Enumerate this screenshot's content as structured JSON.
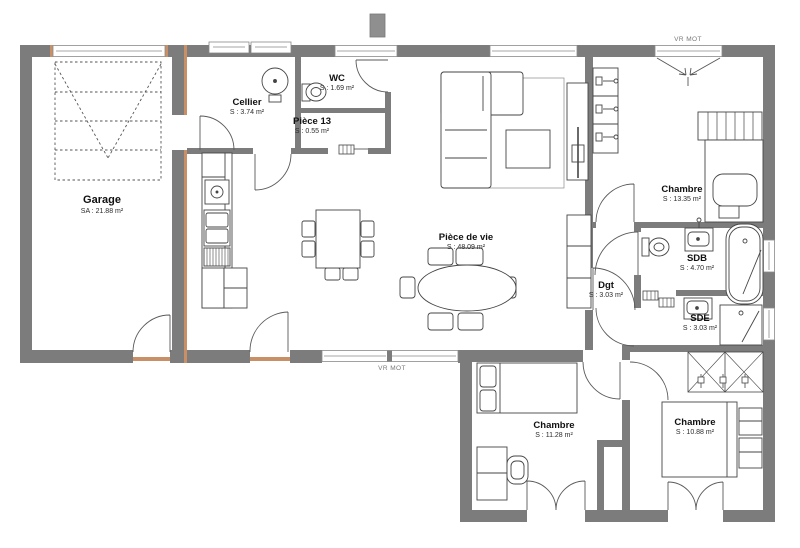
{
  "plan": {
    "rooms": [
      {
        "name": "Garage",
        "area": "SA : 21.88 m²"
      },
      {
        "name": "Cellier",
        "area": "S : 3.74 m²"
      },
      {
        "name": "WC",
        "area": "S : 1.69 m²"
      },
      {
        "name": "Pièce 13",
        "area": "S : 0.55 m²"
      },
      {
        "name": "Pièce de vie",
        "area": "S : 48.09 m²"
      },
      {
        "name": "Chambre",
        "area": "S : 13.35 m²"
      },
      {
        "name": "SDB",
        "area": "S : 4.70 m²"
      },
      {
        "name": "Dgt",
        "area": "S : 3.03 m²"
      },
      {
        "name": "SDE",
        "area": "S : 3.03 m²"
      },
      {
        "name": "Chambre",
        "area": "S : 11.28 m²"
      },
      {
        "name": "Chambre",
        "area": "S : 10.88 m²"
      }
    ],
    "shutters": {
      "top": "VR MOT",
      "bottom": "VR MOT"
    },
    "colors": {
      "wall": "#7c7c7c",
      "accent": "#c99067",
      "line": "#454545",
      "background": "#ffffff"
    }
  }
}
